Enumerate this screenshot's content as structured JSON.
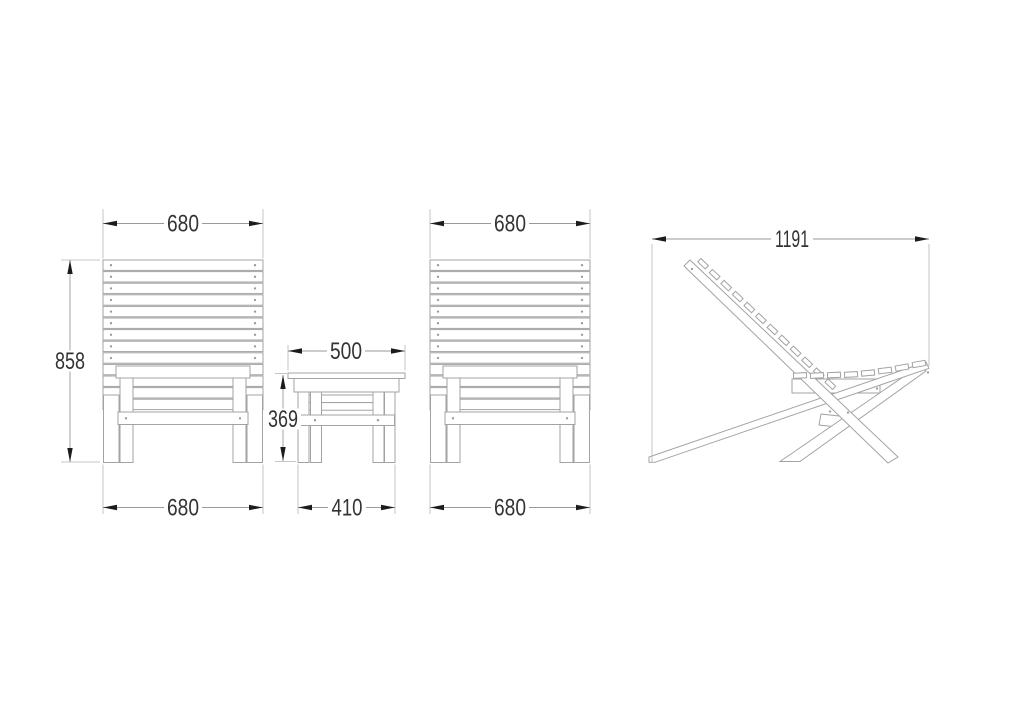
{
  "document": {
    "background": "#ffffff"
  },
  "style": {
    "furniture_line": "#a3a3a3",
    "dim_line": "#9a9a9a",
    "ext_line": "#b5b5b5",
    "arrow": "#1c1c1c",
    "text": "#333333",
    "dot": "#999999"
  },
  "dims": {
    "chair_left_top": "680",
    "chair_left_height": "858",
    "chair_left_bottom": "680",
    "table_top": "500",
    "table_height": "369",
    "table_bottom": "410",
    "chair_right_top": "680",
    "chair_right_bottom": "680",
    "side_depth": "1191"
  }
}
